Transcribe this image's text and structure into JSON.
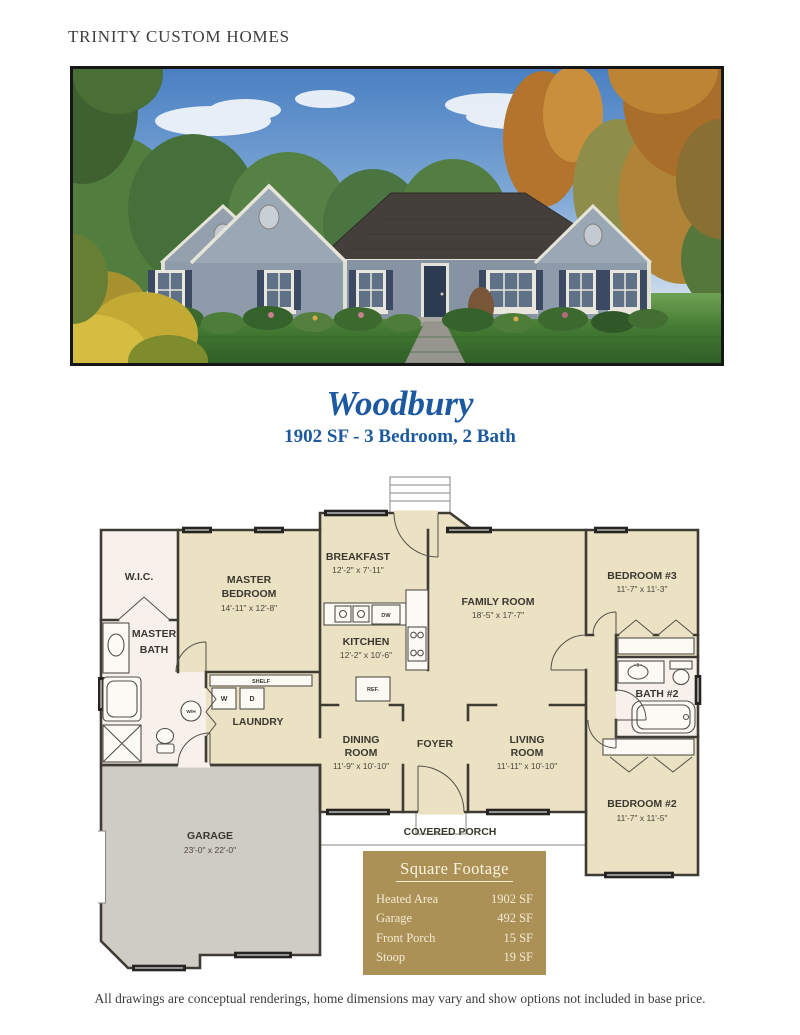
{
  "brand": "TRINITY CUSTOM HOMES",
  "plan": {
    "title": "Woodbury",
    "subtitle": "1902 SF - 3 Bedroom, 2 Bath"
  },
  "colors": {
    "accent_blue": "#1c59a0",
    "table_gold": "#ac9157",
    "plan_tan": "#ebe1c3",
    "plan_pink": "#f8f0eb",
    "garage_gray": "#cfccc5"
  },
  "floor_plan": {
    "rooms": {
      "wic": {
        "name": "W.I.C."
      },
      "master_bedroom": {
        "line1": "MASTER",
        "line2": "BEDROOM",
        "dims": "14'-11\" x 12'-8\""
      },
      "master_bath": {
        "line1": "MASTER",
        "line2": "BATH"
      },
      "breakfast": {
        "name": "BREAKFAST",
        "dims": "12'-2\" x 7'-11\""
      },
      "kitchen": {
        "name": "KITCHEN",
        "dims": "12'-2\" x 10'-6\""
      },
      "family_room": {
        "name": "FAMILY ROOM",
        "dims": "18'-5\" x 17'-7\""
      },
      "bedroom3": {
        "name": "BEDROOM #3",
        "dims": "11'-7\" x 11'-3\""
      },
      "bath2": {
        "name": "BATH #2"
      },
      "laundry": {
        "name": "LAUNDRY"
      },
      "dining": {
        "line1": "DINING",
        "line2": "ROOM",
        "dims": "11'-9\" x 10'-10\""
      },
      "foyer": {
        "name": "FOYER"
      },
      "living": {
        "line1": "LIVING",
        "line2": "ROOM",
        "dims": "11'-11\" x 10'-10\""
      },
      "bedroom2": {
        "name": "BEDROOM #2",
        "dims": "11'-7\" x 11'-5\""
      },
      "garage": {
        "name": "GARAGE",
        "dims": "23'-0\" x 22'-0\""
      },
      "covered_porch": {
        "name": "COVERED PORCH"
      }
    },
    "fixtures": {
      "shelf": "SHELF",
      "washer": "W",
      "dryer": "D",
      "water_heater": "W/H",
      "dishwasher": "DW",
      "refrigerator": "REF."
    }
  },
  "square_footage": {
    "title": "Square Footage",
    "rows": [
      {
        "label": "Heated Area",
        "value": "1902 SF"
      },
      {
        "label": "Garage",
        "value": "492 SF"
      },
      {
        "label": "Front Porch",
        "value": "15 SF"
      },
      {
        "label": "Stoop",
        "value": "19 SF"
      }
    ]
  },
  "disclaimer": "All drawings are conceptual renderings, home dimensions may vary and show options not included in base price."
}
